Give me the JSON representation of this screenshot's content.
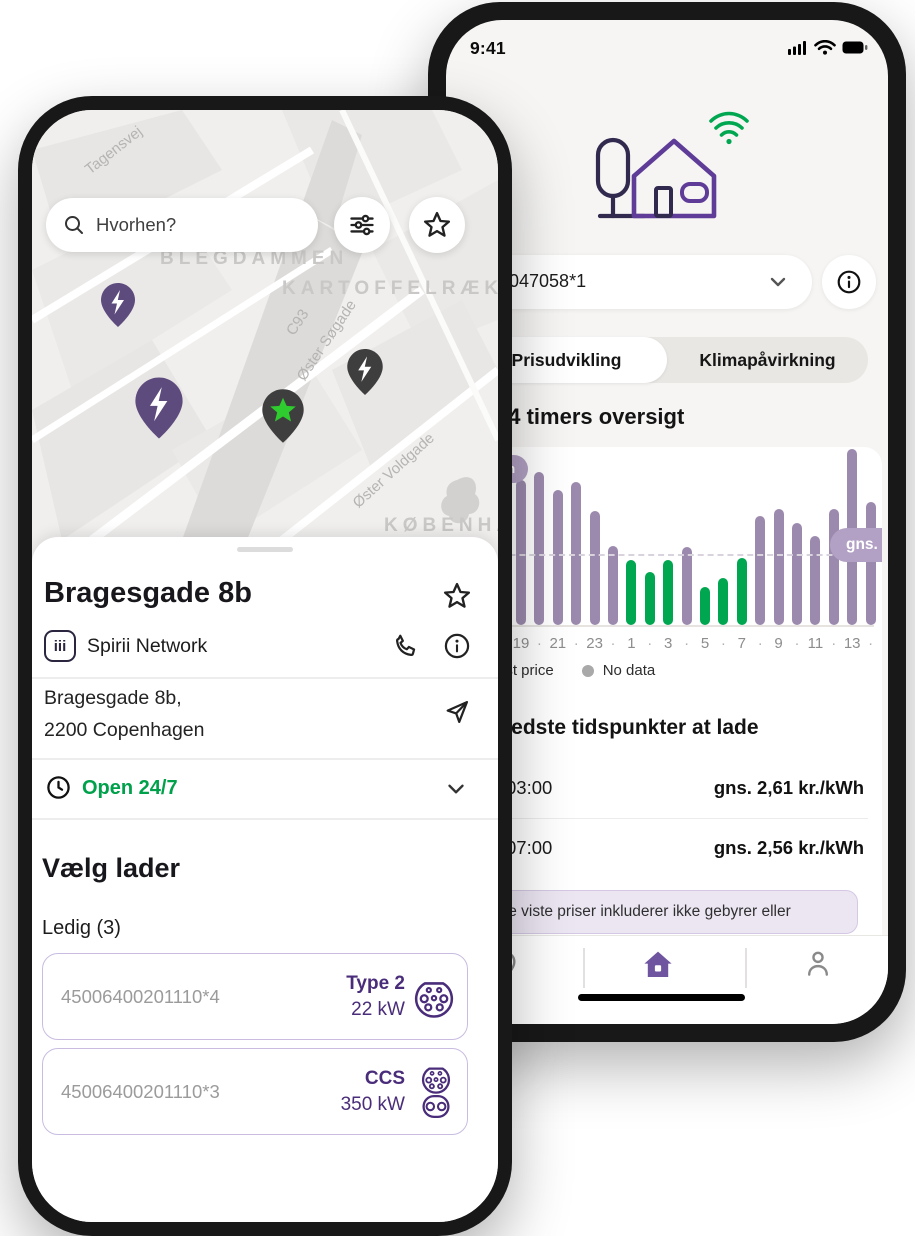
{
  "left_phone": {
    "map": {
      "street_labels": {
        "tagensvej": "Tagensvej",
        "blegdammen": "BLEGDAMMEN",
        "kartoffelraekkerne": "KARTOFFELRÆKKERN",
        "c93": "C93",
        "oster_sogade": "Øster Søgade",
        "oster_voldgade": "Øster Voldgade",
        "kobenhavn": "KØBENHAV"
      },
      "pin_colors": {
        "available": "#5e4b7e",
        "occupied": "#3f3e3e",
        "selected_star": "#2ecc2e"
      }
    },
    "search": {
      "placeholder": "Hvorhen?"
    },
    "sheet": {
      "title": "Bragesgade 8b",
      "network_logo": "iii",
      "network_name": "Spirii Network",
      "address_line1": "Bragesgade 8b,",
      "address_line2": "2200 Copenhagen",
      "opening_hours": "Open 24/7",
      "opening_color": "#00A14B",
      "choose_charger_title": "Vælg lader",
      "availability_label": "Ledig (3)",
      "chargers": [
        {
          "id": "45006400201110*4",
          "type": "Type 2",
          "power": "22 kW"
        },
        {
          "id": "45006400201110*3",
          "type": "CCS",
          "power": "350 kW"
        }
      ]
    }
  },
  "right_phone": {
    "status_time": "9:41",
    "device_select": {
      "value": "D047058*1"
    },
    "tabs": {
      "items": [
        "Prisudvikling",
        "Klimapåvirkning"
      ],
      "selected": "Prisudvikling"
    },
    "overview_title": "24 timers oversigt",
    "chart_data": {
      "type": "bar",
      "title": "24 timers oversigt",
      "ylabel_pill": "kr./kWh",
      "x_hours": [
        "19",
        "20",
        "21",
        "22",
        "23",
        "0",
        "1",
        "2",
        "3",
        "4",
        "5",
        "6",
        "7",
        "8",
        "9",
        "10",
        "11",
        "12",
        "13",
        "14"
      ],
      "bars": [
        {
          "v": 2.55,
          "t": "normal"
        },
        {
          "v": 2.69,
          "t": "normal"
        },
        {
          "v": 2.37,
          "t": "normal"
        },
        {
          "v": 2.51,
          "t": "normal"
        },
        {
          "v": 2.0,
          "t": "normal"
        },
        {
          "v": 1.39,
          "t": "normal"
        },
        {
          "v": 1.14,
          "t": "best"
        },
        {
          "v": 0.93,
          "t": "best"
        },
        {
          "v": 1.14,
          "t": "best"
        },
        {
          "v": 1.37,
          "t": "normal"
        },
        {
          "v": 0.67,
          "t": "best"
        },
        {
          "v": 0.83,
          "t": "best"
        },
        {
          "v": 1.18,
          "t": "best"
        },
        {
          "v": 1.92,
          "t": "normal"
        },
        {
          "v": 2.04,
          "t": "normal"
        },
        {
          "v": 1.79,
          "t": "normal"
        },
        {
          "v": 1.56,
          "t": "normal"
        },
        {
          "v": 2.04,
          "t": "normal"
        },
        {
          "v": 3.08,
          "t": "normal"
        },
        {
          "v": 2.16,
          "t": "normal"
        }
      ],
      "palette": {
        "normal": "#9c8aae",
        "best": "#00a650"
      },
      "average_value": 1.23,
      "average_label": "gns. 1,23 kr./kWh",
      "tick_labels": [
        "19",
        "21",
        "23",
        "1",
        "3",
        "5",
        "7",
        "9",
        "11",
        "13"
      ],
      "tick_separator": "·"
    },
    "legend": [
      {
        "label": "Best price",
        "color": "#00a650"
      },
      {
        "label": "No data",
        "color": "#a9a9a9"
      }
    ],
    "best_section": {
      "title": "Bedste tidspunkter at lade",
      "rows": [
        {
          "time": "03:00",
          "price": "gns. 2,61 kr./kWh"
        },
        {
          "time": "07:00",
          "price": "gns. 2,56 kr./kWh"
        }
      ]
    },
    "note": "De viste priser inkluderer ikke gebyrer eller",
    "accent_purple": "#6f55a0"
  }
}
